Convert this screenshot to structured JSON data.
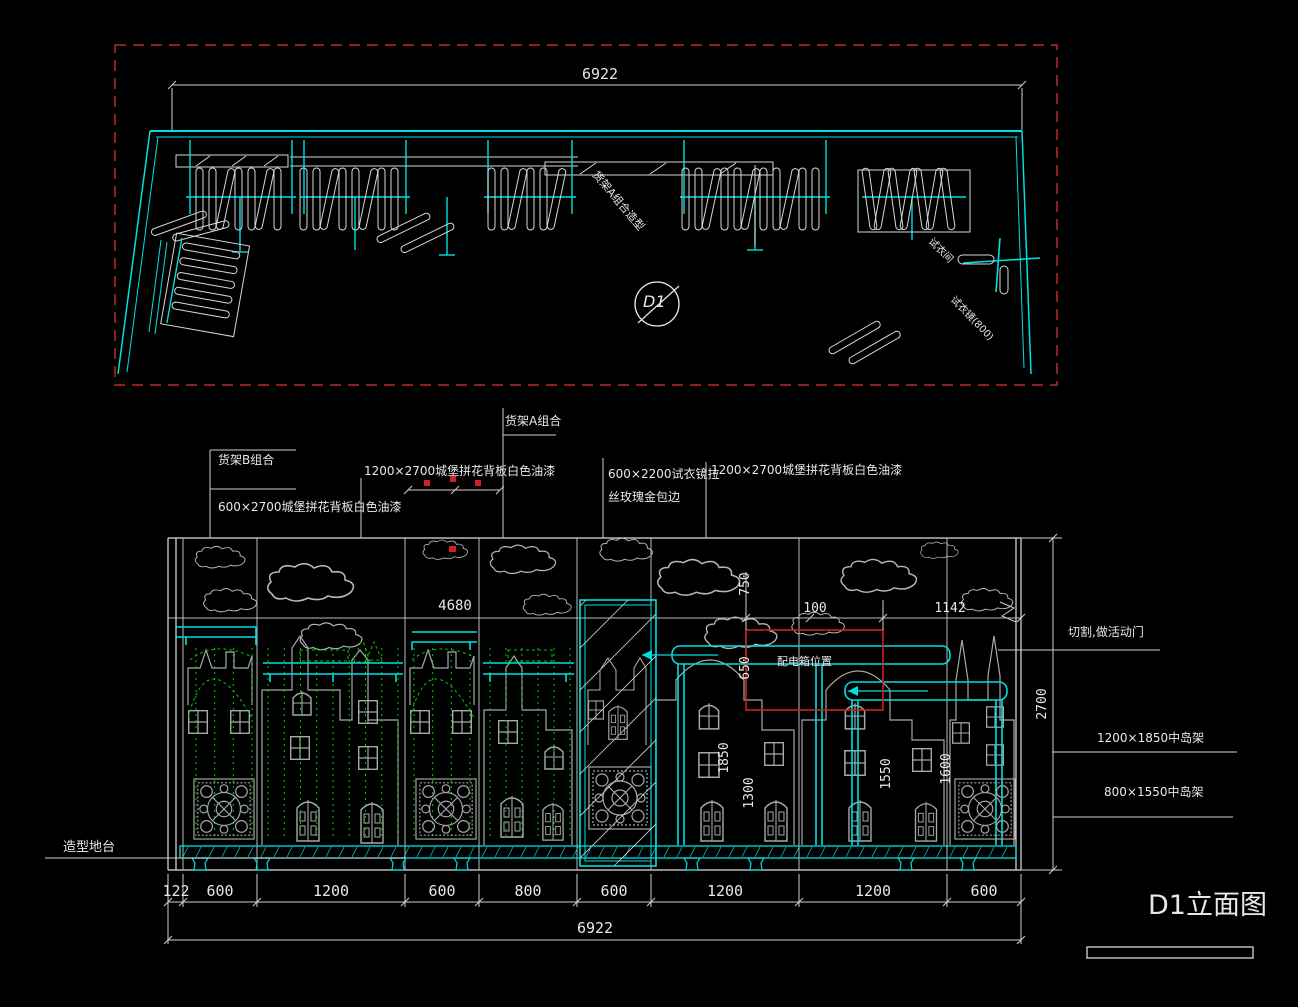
{
  "app": {
    "background": "#000000"
  },
  "plan": {
    "total_dimension": "6922",
    "section_marker": "D1",
    "labels": {
      "rack_a": "货架A组合造型",
      "fitting_room": "试衣间",
      "fitting_mirror": "试衣镜(800)"
    }
  },
  "elevation": {
    "title": "D1立面图",
    "callouts": {
      "rack_b": "货架B组合",
      "backboard_600": "600×2700城堡拼花背板白色油漆",
      "backboard_1200_left": "1200×2700城堡拼花背板白色油漆",
      "rack_a": "货架A组合",
      "mirror_line1": "600×2200试衣镜拉",
      "mirror_line2": "丝玫瑰金包边",
      "backboard_1200_right": "1200×2700城堡拼花背板白色油漆",
      "cut_door": "切割,做活动门",
      "island_large": "1200×1850中岛架",
      "island_small": "800×1550中岛架",
      "platform": "造型地台",
      "power_box": "配电箱位置"
    },
    "dimensions": {
      "d4680": "4680",
      "d750": "750",
      "d100": "100",
      "d1142": "1142",
      "d650": "650",
      "d1850": "1850",
      "d1300": "1300",
      "d1550": "1550",
      "d1600": "1600",
      "d2700": "2700",
      "bottom": [
        "122",
        "600",
        "1200",
        "600",
        "800",
        "600",
        "1200",
        "1200",
        "600"
      ],
      "total": "6922"
    }
  },
  "colors": {
    "cyan": "#00e0e0",
    "green": "#00cc00",
    "red": "#cc2222",
    "border_red": "#8a2020",
    "white": "#e8e8e8",
    "gray": "#a8a8a8"
  }
}
